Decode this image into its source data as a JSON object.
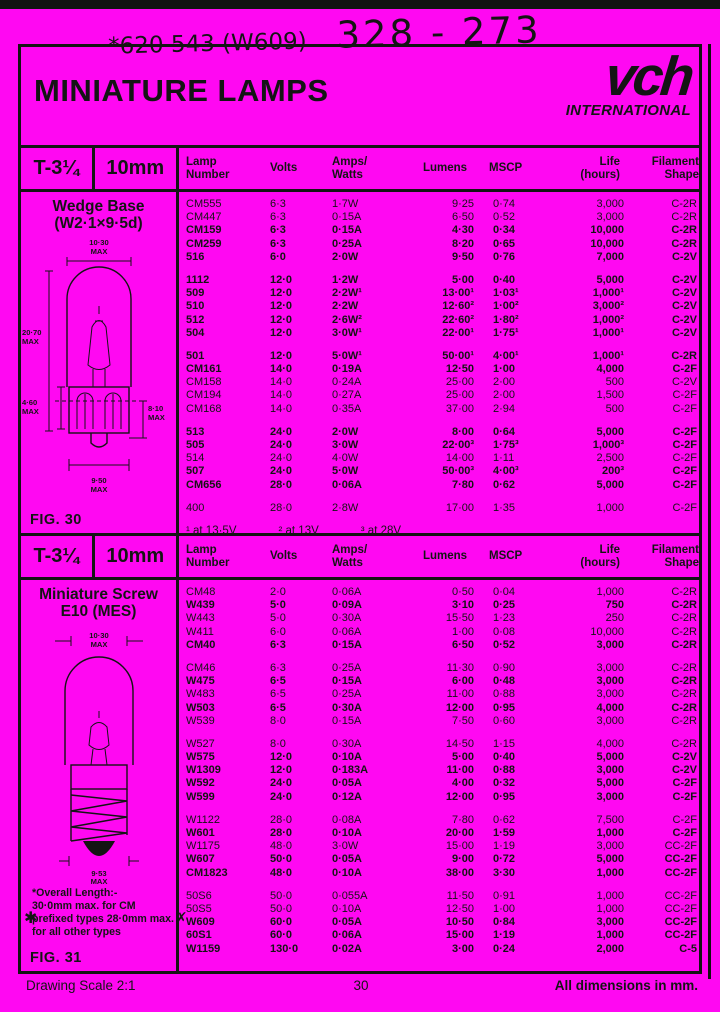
{
  "colors": {
    "background": "#ff08f2",
    "ink": "#141414"
  },
  "handwriting": {
    "left": "*620  543 (W609)",
    "right": "328 - 273"
  },
  "header": {
    "title": "MINIATURE LAMPS",
    "logo": "vch",
    "logo_sub": "INTERNATIONAL"
  },
  "columns": [
    "Lamp\nNumber",
    "Volts",
    "Amps/\nWatts",
    "Lumens",
    "MSCP",
    "Life\n(hours)",
    "Filament\nShape"
  ],
  "table1": {
    "size": "T-3¼",
    "diameter": "10mm",
    "panel": {
      "heading1": "Wedge Base",
      "heading2": "(W2·1×9·5d)",
      "fig": "FIG. 30",
      "dims": {
        "top_v": "10·30",
        "top_u": "MAX",
        "left_v": "20·70",
        "left_u": "MAX",
        "mid_v": "4·60",
        "mid_u": "MAX",
        "right_v": "8·10",
        "right_u": "MAX",
        "bottom_v": "9·50",
        "bottom_u": "MAX"
      }
    },
    "groups": [
      [
        {
          "cells": [
            "CM555",
            "6·3",
            "1·7W",
            "9·25",
            "0·74",
            "3,000",
            "C-2R"
          ]
        },
        {
          "cells": [
            "CM447",
            "6·3",
            "0·15A",
            "6·50",
            "0·52",
            "3,000",
            "C-2R"
          ]
        },
        {
          "cells": [
            "CM159",
            "6·3",
            "0·15A",
            "4·30",
            "0·34",
            "10,000",
            "C-2R"
          ],
          "bold": true
        },
        {
          "cells": [
            "CM259",
            "6·3",
            "0·25A",
            "8·20",
            "0·65",
            "10,000",
            "C-2R"
          ],
          "bold": true
        },
        {
          "cells": [
            "516",
            "6·0",
            "2·0W",
            "9·50",
            "0·76",
            "7,000",
            "C-2V"
          ],
          "bold": true
        }
      ],
      [
        {
          "cells": [
            "1112",
            "12·0",
            "1·2W",
            "5·00",
            "0·40",
            "5,000",
            "C-2V"
          ],
          "bold": true
        },
        {
          "cells": [
            "509",
            "12·0",
            "2·2W¹",
            "13·00¹",
            "1·03¹",
            "1,000¹",
            "C-2V"
          ],
          "bold": true
        },
        {
          "cells": [
            "510",
            "12·0",
            "2·2W",
            "12·60²",
            "1·00²",
            "3,000²",
            "C-2V"
          ],
          "bold": true
        },
        {
          "cells": [
            "512",
            "12·0",
            "2·6W²",
            "22·60²",
            "1·80²",
            "1,000²",
            "C-2V"
          ],
          "bold": true
        },
        {
          "cells": [
            "504",
            "12·0",
            "3·0W¹",
            "22·00¹",
            "1·75¹",
            "1,000¹",
            "C-2V"
          ],
          "bold": true
        }
      ],
      [
        {
          "cells": [
            "501",
            "12·0",
            "5·0W¹",
            "50·00¹",
            "4·00¹",
            "1,000¹",
            "C-2R"
          ],
          "bold": true
        },
        {
          "cells": [
            "CM161",
            "14·0",
            "0·19A",
            "12·50",
            "1·00",
            "4,000",
            "C-2F"
          ],
          "bold": true
        },
        {
          "cells": [
            "CM158",
            "14·0",
            "0·24A",
            "25·00",
            "2·00",
            "500",
            "C-2V"
          ]
        },
        {
          "cells": [
            "CM194",
            "14·0",
            "0·27A",
            "25·00",
            "2·00",
            "1,500",
            "C-2F"
          ]
        },
        {
          "cells": [
            "CM168",
            "14·0",
            "0·35A",
            "37·00",
            "2·94",
            "500",
            "C-2F"
          ]
        }
      ],
      [
        {
          "cells": [
            "513",
            "24·0",
            "2·0W",
            "8·00",
            "0·64",
            "5,000",
            "C-2F"
          ],
          "bold": true
        },
        {
          "cells": [
            "505",
            "24·0",
            "3·0W",
            "22·00³",
            "1·75³",
            "1,000³",
            "C-2F"
          ],
          "bold": true
        },
        {
          "cells": [
            "514",
            "24·0",
            "4·0W",
            "14·00",
            "1·11",
            "2,500",
            "C-2F"
          ]
        },
        {
          "cells": [
            "507",
            "24·0",
            "5·0W",
            "50·00³",
            "4·00³",
            "200³",
            "C-2F"
          ],
          "bold": true
        },
        {
          "cells": [
            "CM656",
            "28·0",
            "0·06A",
            "7·80",
            "0·62",
            "5,000",
            "C-2F"
          ],
          "bold": true
        }
      ],
      [
        {
          "cells": [
            "400",
            "28·0",
            "2·8W",
            "17·00",
            "1·35",
            "1,000",
            "C-2F"
          ]
        }
      ]
    ],
    "footnotes": [
      "¹ at 13·5V",
      "² at 13V",
      "³ at 28V"
    ]
  },
  "table2": {
    "size": "T-3¼",
    "diameter": "10mm",
    "panel": {
      "heading1": "Miniature Screw",
      "heading2": "E10 (MES)",
      "fig": "FIG. 31",
      "dims": {
        "top_v": "10·30",
        "top_u": "MAX",
        "bottom_v": "9·53",
        "bottom_u": "MAX"
      },
      "note": "*Overall Length:-\n30·0mm max. for CM\nprefixed types 28·0mm max.\nfor all other types",
      "mark": "✱"
    },
    "groups": [
      [
        {
          "cells": [
            "CM48",
            "2·0",
            "0·06A",
            "0·50",
            "0·04",
            "1,000",
            "C-2R"
          ]
        },
        {
          "cells": [
            "W439",
            "5·0",
            "0·09A",
            "3·10",
            "0·25",
            "750",
            "C-2R"
          ],
          "bold": true
        },
        {
          "cells": [
            "W443",
            "5·0",
            "0·30A",
            "15·50",
            "1·23",
            "250",
            "C-2R"
          ]
        },
        {
          "cells": [
            "W411",
            "6·0",
            "0·06A",
            "1·00",
            "0·08",
            "10,000",
            "C-2R"
          ]
        },
        {
          "cells": [
            "CM40",
            "6·3",
            "0·15A",
            "6·50",
            "0·52",
            "3,000",
            "C-2R"
          ],
          "bold": true
        }
      ],
      [
        {
          "cells": [
            "CM46",
            "6·3",
            "0·25A",
            "11·30",
            "0·90",
            "3,000",
            "C-2R"
          ]
        },
        {
          "cells": [
            "W475",
            "6·5",
            "0·15A",
            "6·00",
            "0·48",
            "3,000",
            "C-2R"
          ],
          "bold": true
        },
        {
          "cells": [
            "W483",
            "6·5",
            "0·25A",
            "11·00",
            "0·88",
            "3,000",
            "C-2R"
          ]
        },
        {
          "cells": [
            "W503",
            "6·5",
            "0·30A",
            "12·00",
            "0·95",
            "4,000",
            "C-2R"
          ],
          "bold": true
        },
        {
          "cells": [
            "W539",
            "8·0",
            "0·15A",
            "7·50",
            "0·60",
            "3,000",
            "C-2R"
          ]
        }
      ],
      [
        {
          "cells": [
            "W527",
            "8·0",
            "0·30A",
            "14·50",
            "1·15",
            "4,000",
            "C-2R"
          ]
        },
        {
          "cells": [
            "W575",
            "12·0",
            "0·10A",
            "5·00",
            "0·40",
            "5,000",
            "C-2V"
          ],
          "bold": true
        },
        {
          "cells": [
            "W1309",
            "12·0",
            "0·183A",
            "11·00",
            "0·88",
            "3,000",
            "C-2V"
          ],
          "bold": true
        },
        {
          "cells": [
            "W592",
            "24·0",
            "0·05A",
            "4·00",
            "0·32",
            "5,000",
            "C-2F"
          ],
          "bold": true
        },
        {
          "cells": [
            "W599",
            "24·0",
            "0·12A",
            "12·00",
            "0·95",
            "3,000",
            "C-2F"
          ],
          "bold": true
        }
      ],
      [
        {
          "cells": [
            "W1122",
            "28·0",
            "0·08A",
            "7·80",
            "0·62",
            "7,500",
            "C-2F"
          ]
        },
        {
          "cells": [
            "W601",
            "28·0",
            "0·10A",
            "20·00",
            "1·59",
            "1,000",
            "C-2F"
          ],
          "bold": true
        },
        {
          "cells": [
            "W1175",
            "48·0",
            "3·0W",
            "15·00",
            "1·19",
            "3,000",
            "CC-2F"
          ]
        },
        {
          "cells": [
            "W607",
            "50·0",
            "0·05A",
            "9·00",
            "0·72",
            "5,000",
            "CC-2F"
          ],
          "bold": true
        },
        {
          "cells": [
            "CM1823",
            "48·0",
            "0·10A",
            "38·00",
            "3·30",
            "1,000",
            "CC-2F"
          ],
          "bold": true
        }
      ],
      [
        {
          "cells": [
            "50S6",
            "50·0",
            "0·055A",
            "11·50",
            "0·91",
            "1,000",
            "CC-2F"
          ]
        },
        {
          "cells": [
            "50S5",
            "50·0",
            "0·10A",
            "12·50",
            "1·00",
            "1,000",
            "CC-2F"
          ]
        },
        {
          "cells": [
            "W609",
            "60·0",
            "0·05A",
            "10·50",
            "0·84",
            "3,000",
            "CC-2F"
          ],
          "bold": true,
          "mark": "✗"
        },
        {
          "cells": [
            "60S1",
            "60·0",
            "0·06A",
            "15·00",
            "1·19",
            "1,000",
            "CC-2F"
          ],
          "bold": true
        },
        {
          "cells": [
            "W1159",
            "130·0",
            "0·02A",
            "3·00",
            "0·24",
            "2,000",
            "C-5"
          ],
          "bold": true
        }
      ]
    ]
  },
  "footer": {
    "left": "Drawing Scale 2:1",
    "page": "30",
    "right": "All dimensions in mm."
  }
}
